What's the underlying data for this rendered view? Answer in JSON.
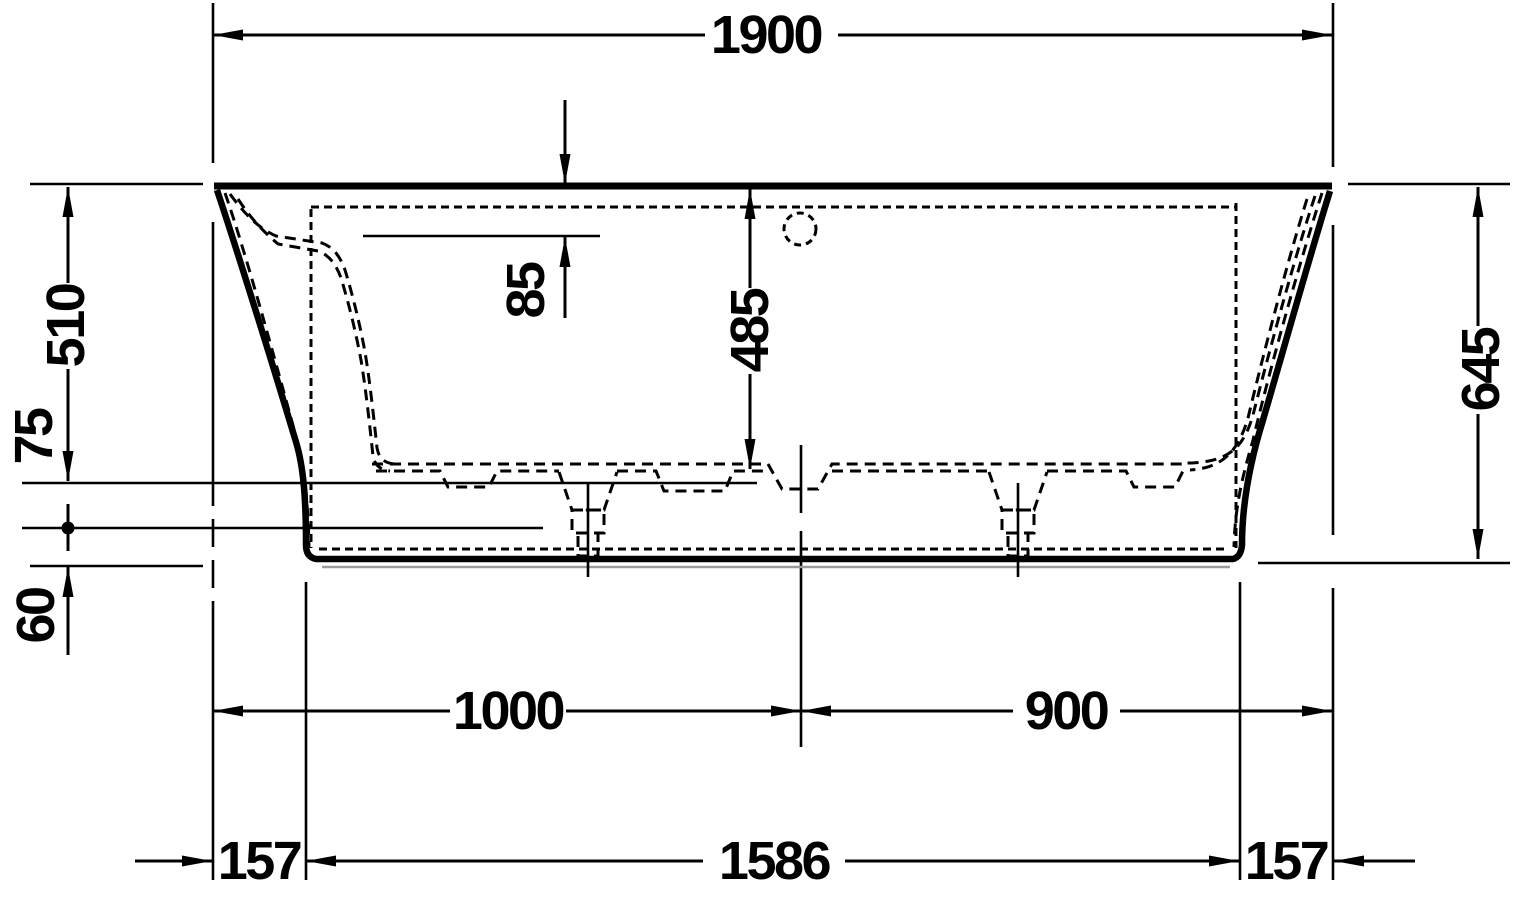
{
  "drawing": {
    "dim_overall_length": "1900",
    "dim_waterline": "85",
    "dim_inner_depth": "485",
    "dim_rim_to_base": "510",
    "dim_base_to_foot": "75",
    "dim_foot_height": "60",
    "dim_overall_height": "645",
    "dim_left_to_drain": "1000",
    "dim_drain_to_right": "900",
    "dim_base_offset_left": "157",
    "dim_base_length": "1586",
    "dim_base_offset_right": "157"
  }
}
